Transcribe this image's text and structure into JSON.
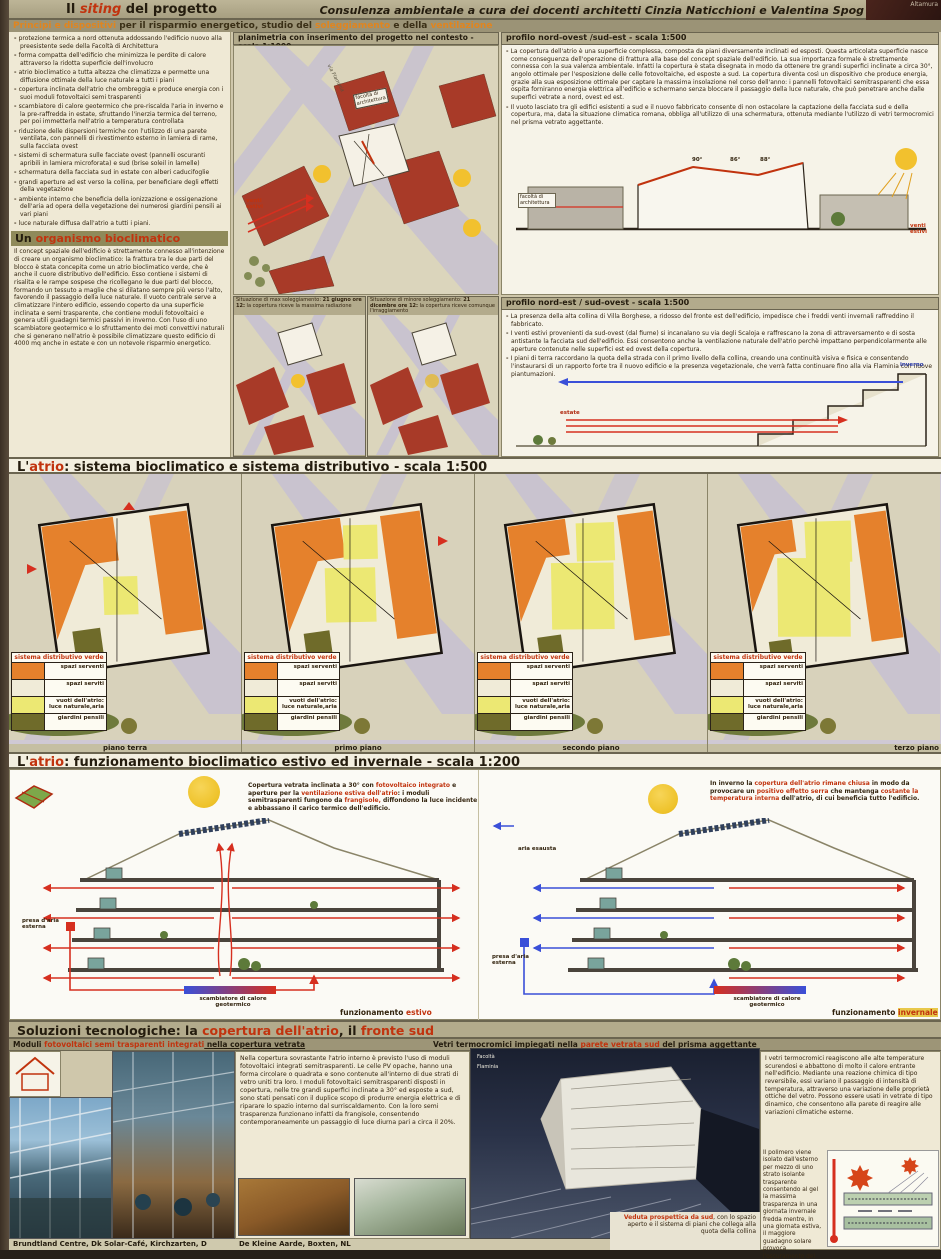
{
  "palette": {
    "poster_bg": "#cfc7ab",
    "band_olive": "#9b9376",
    "paper": "#f3efe0",
    "accent_red": "#c1330e",
    "accent_orange": "#e0851f",
    "map_building_red": "#a83a28",
    "road_lavender": "#c9c3cf",
    "plan_orange": "#e5812c",
    "plan_yellow": "#ece873",
    "plan_cream": "#f0ebd8",
    "plan_olive": "#6f6b2a",
    "sun_yellow": "#f2c12e",
    "arrow_red": "#d62f1f",
    "arrow_blue": "#3a4fd8"
  },
  "header": {
    "title_pre": "Il ",
    "title_accent": "siting",
    "title_post": " del progetto",
    "credit": "Consulenza ambientale a cura dei docenti architetti Cinzia Naticchioni e Valentina Spog",
    "corner": "Altamura",
    "principi_s1": "Principi e dispositivi",
    "principi_s2": " per il risparmio energetico, studio del ",
    "principi_s3": "soleggiamento",
    "principi_s4": " e della ",
    "principi_s5": "ventilazione"
  },
  "left": {
    "bullets": [
      "protezione termica a nord ottenuta addossando l'edificio nuovo alla preesistente sede della Facoltà di Architettura",
      "forma compatta dell'edificio che minimizza le perdite di calore attraverso la ridotta superficie dell'involucro",
      "atrio bioclimatico a tutta altezza che climatizza e permette una diffusione ottimale della luce naturale a tutti i piani",
      "copertura inclinata dell'atrio che ombreggia e produce energia con i suoi moduli fotovoltaici semi trasparenti",
      "scambiatore di calore geotermico che pre-riscalda l'aria in inverno e la pre-raffredda in estate, sfruttando l'inerzia termica del terreno, per poi immetterla nell'atrio a temperatura controllata",
      "riduzione delle dispersioni termiche con l'utilizzo di una parete ventilata, con pannelli di rivestimento esterno in lamiera di rame, sulla facciata ovest",
      "sistemi di schermatura sulle facciate ovest (pannelli oscuranti apribili in lamiera microforata) e sud (brise soleil in lamelle)",
      "schermatura della facciata sud in estate con alberi caducifoglie",
      "grandi aperture ad est verso la collina, per beneficiare degli effetti della vegetazione",
      "ambiente interno che beneficia della ionizzazione e ossigenazione dell'aria ad opera della vegetazione dei numerosi giardini pensili ai vari piani",
      "luce naturale diffusa dall'atrio a tutti i piani."
    ],
    "organismo_title_pre": "Un ",
    "organismo_title_accent": "organismo bioclimatico",
    "organismo_body": "Il concept spaziale dell'edificio è strettamente connesso all'intenzione di creare un organismo bioclimatico: la frattura tra le due parti del blocco è stata concepita come un atrio bioclimatico verde, che è anche il cuore distributivo dell'edificio. Esso contiene i sistemi di risalita e le rampe sospese che ricollegano le due parti del blocco, formando un tessuto a maglie che si dilatano sempre più verso l'alto, favorendo il passaggio della luce naturale. Il vuoto centrale serve a climatizzare l'intero edificio, essendo coperto da una superficie inclinata e semi trasparente, che contiene moduli fotovoltaici e genera utili guadagni termici passivi in inverno. Con l'uso di uno scambiatore geotermico e lo sfruttamento dei moti convettivi naturali che si generano nell'atrio è possibile climatizzare questo edificio di 4000 mq anche in estate e con un notevole risparmio energetico."
  },
  "planimetria": {
    "header": "planimetria con inserimento del progetto nel contesto - scala 1:1000",
    "facolta": "facoltà di architettura",
    "via": "via Flaminia",
    "venti": "venti estivi",
    "sole_max_pre": "Situazione di max soleggiamento: ",
    "sole_max_date": "21 giugno ore 12:",
    "sole_max_post": " la copertura riceve la massima radiazione",
    "sole_min_pre": "Situazione di minore soleggiamento: ",
    "sole_min_date": "21 dicembre ore 12:",
    "sole_min_post": " la copertura riceve comunque l'irraggiamento"
  },
  "profilo_nw": {
    "header": "profilo nord-ovest /sud-est - scala 1:500",
    "b1": "La copertura dell'atrio è una superficie complessa, composta da piani diversamente inclinati ed esposti. Questa articolata superficie nasce come conseguenza dell'operazione di frattura alla base del concept spaziale dell'edificio. La sua importanza formale è strettamente connessa con la sua valenza ambientale. Infatti la copertura è stata disegnata in modo da ottenere tre grandi superfici inclinate a circa 30°, angolo ottimale per l'esposizione delle celle fotovoltaiche, ed esposte a sud. La copertura diventa così un dispositivo che produce energia, grazie alla sua esposizione ottimale per captare la massima insolazione nel corso dell'anno: i pannelli fotovoltaici semitrasparenti che essa ospita forniranno energia elettrica all'edificio e schermano senza bloccare il passaggio della luce naturale, che può penetrare anche dalle superfici vetrate a nord, ovest ed est.",
    "b2": "Il vuoto lasciato tra gli edifici esistenti a sud e il nuovo fabbricato consente di non ostacolare la captazione della facciata sud e della copertura, ma, data la situazione climatica romana, obbliga all'utilizzo di una schermatura, ottenuta mediante l'utilizzo di vetri termocromici nel prisma vetrato aggettante.",
    "angle1": "90°",
    "angle2": "86°",
    "angle3": "88°",
    "facolta": "facoltà di architettura",
    "venti": "venti estivi"
  },
  "profilo_ne": {
    "header": "profilo nord-est / sud-ovest - scala 1:500",
    "b1": "La presenza della alta collina di Villa Borghese, a ridosso del fronte est dell'edificio, impedisce che i freddi venti invernali raffreddino il fabbricato.",
    "b2": "I venti estivi provenienti da sud-ovest (dal fiume) si incanalano su via degli Scaloja e raffrescano la zona di attraversamento e di sosta antistante la facciata sud dell'edificio. Essi consentono anche la ventilazione naturale dell'atrio perchè impattano perpendicolarmente alle aperture contenute nelle superfici est ed ovest della copertura.",
    "b3": "I piani di terra raccordano la quota della strada con il primo livello della collina, creando una continuità visiva e fisica e consentendo l'instaurarsi di un rapporto forte tra il nuovo edificio e la presenza vegetazionale, che verrà fatta continuare fino alla via Flaminia con nuove piantumazioni.",
    "inverno": "inverno",
    "estate": "estate"
  },
  "atrio1": {
    "pre": "L'",
    "accent": "atrio",
    "post": ": sistema bioclimatico e sistema distributivo - scala 1:500"
  },
  "legend": {
    "title": "sistema distributivo verde",
    "rows": [
      {
        "label": "spazi serventi",
        "color": "#e5812c"
      },
      {
        "label": "spazi serviti",
        "color": "#f0ebd8"
      },
      {
        "label": "vuoti dell'atrio: luce naturale,aria",
        "color": "#ece873"
      },
      {
        "label": "giardini pensili",
        "color": "#6f6b2a"
      }
    ]
  },
  "plans": {
    "cap1": "piano terra",
    "cap2": "primo piano",
    "cap3": "secondo piano",
    "cap4": "terzo piano"
  },
  "atrio2": {
    "pre": "L'",
    "accent": "atrio",
    "post": ": funzionamento bioclimatico estivo ed invernale - scala 1:200"
  },
  "sezioni": {
    "estate_s1": "Copertura vetrata inclinata a 30° con ",
    "estate_s2": "fotovoltaico integrato",
    "estate_s3": " e aperture per la ",
    "estate_s4": "ventilazione estiva dell'atrio",
    "estate_s5": ": i moduli semitrasparenti fungono da ",
    "estate_s6": "frangisole,",
    "estate_s7": " diffondono la luce incidente e abbassano il carico termico dell'edificio.",
    "inverno_s1": "In inverno la ",
    "inverno_s2": "copertura dell'atrio rimane chiusa",
    "inverno_s3": " in modo da provocare un ",
    "inverno_s4": "positivo effetto serra",
    "inverno_s5": " che mantenga ",
    "inverno_s6": "costante la temperatura interna",
    "inverno_s7": " dell'atrio, di cui beneficia tutto l'edificio.",
    "presa": "presa d'aria esterna",
    "aria_esausta": "aria esausta",
    "scambiatore": "scambiatore di calore geotermico",
    "cap_fun": "funzionamento ",
    "cap_estivo": "estivo",
    "cap_invernale": "invernale"
  },
  "soluzioni": {
    "s1": "Soluzioni tecnologiche: la ",
    "s2": "copertura dell'atrio",
    "s3": ", il ",
    "s4": "fronte sud"
  },
  "moduli": {
    "h1": "Moduli ",
    "h2": "fotovoltaici semi trasparenti integrati",
    "h3": " nella copertura vetrata",
    "body": "Nella copertura sovrastante l'atrio interno è previsto l'uso di moduli fotovoltaici integrati semitrasparenti. Le celle PV opache, hanno una forma circolare o quadrata e sono contenute all'interno di due strati di vetro uniti tra loro. I moduli fotovoltaici semitrasparenti disposti in copertura, nelle tre grandi superfici inclinate a 30° ed esposte a sud, sono stati pensati con il duplice scopo di produrre energia elettrica e di riparare lo spazio interno dal surriscaldamento. Con la loro semi trasparenza funzionano infatti da frangisole, consentendo contemporaneamente un passaggio di luce diurna pari a circa il 20%."
  },
  "vetri": {
    "h1": "Vetri termocromici impiegati nella ",
    "h2": "parete vetrata sud",
    "h3": " del prisma aggettante",
    "p1": "I vetri termocromici reagiscono alle alte temperature scurendosi e abbattono di molto il calore entrante nell'edificio. Mediante una reazione chimica di tipo reversibile, essi variano il passaggio di intensità di temperatura, attraverso una variazione delle proprietà ottiche del vetro. Possono essere usati in vetrate di tipo dinamico, che consentono alla parete di reagire alle variazioni climatiche esterne.",
    "p2": "Il polimero viene isolato dall'esterno per mezzo di uno strato isolante trasparente consentendo al gel la massima trasparenza in una giornata invernale fredda mentre, in una giornata estiva, il maggiore guadagno solare provoca l'oscuramento del materiale."
  },
  "photos": {
    "cap1": "Brundtland Centre, Dk  Solar-Café, Kirchzarten, D",
    "cap2": "De Kleine Aarde, Boxten, NL"
  },
  "veduta": {
    "a": "Veduta prospettica da sud",
    "b": ", con lo spazio aperto e il sistema di piani che collega alla quota della collina"
  },
  "render_labels": {
    "facolta": "Facoltà",
    "flaminia": "Flaminia"
  }
}
